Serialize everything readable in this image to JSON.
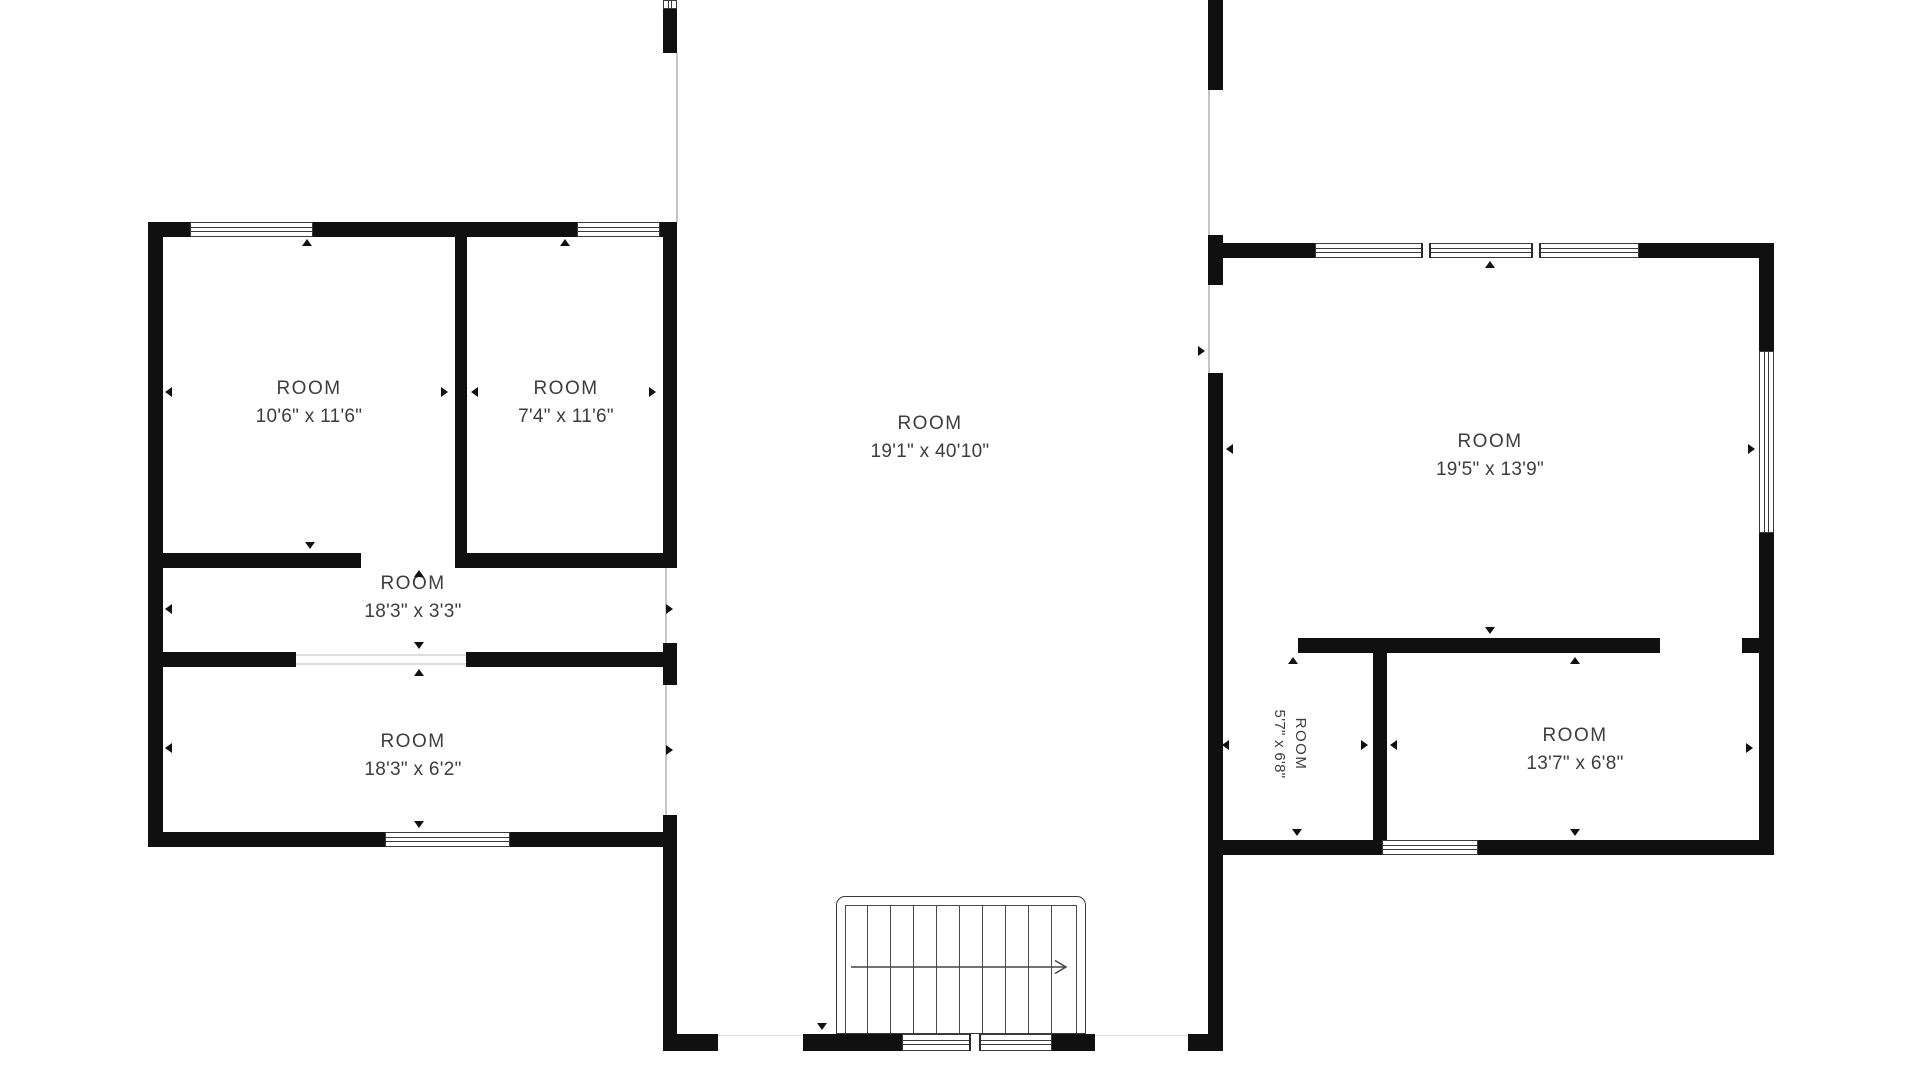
{
  "floorplan": {
    "rooms": [
      {
        "id": "room-top-left",
        "label": "ROOM",
        "dimensions": "10'6\" x 11'6\""
      },
      {
        "id": "room-top-middle",
        "label": "ROOM",
        "dimensions": "7'4\" x 11'6\""
      },
      {
        "id": "center-hall",
        "label": "ROOM",
        "dimensions": "19'1\" x 40'10\""
      },
      {
        "id": "hallway",
        "label": "ROOM",
        "dimensions": "18'3\" x 3'3\""
      },
      {
        "id": "room-bottom-left",
        "label": "ROOM",
        "dimensions": "18'3\" x 6'2\""
      },
      {
        "id": "room-right-large",
        "label": "ROOM",
        "dimensions": "19'5\" x 13'9\""
      },
      {
        "id": "room-right-small",
        "label": "ROOM",
        "dimensions": "5'7\" x 6'8\""
      },
      {
        "id": "room-right-bottom",
        "label": "ROOM",
        "dimensions": "13'7\" x 6'8\""
      }
    ],
    "stairs": {
      "direction_arrow": "right"
    },
    "colors": {
      "wall": "#101010",
      "text": "#3d3d3d",
      "opening_line": "#c6c6c6",
      "background": "#ffffff"
    }
  }
}
